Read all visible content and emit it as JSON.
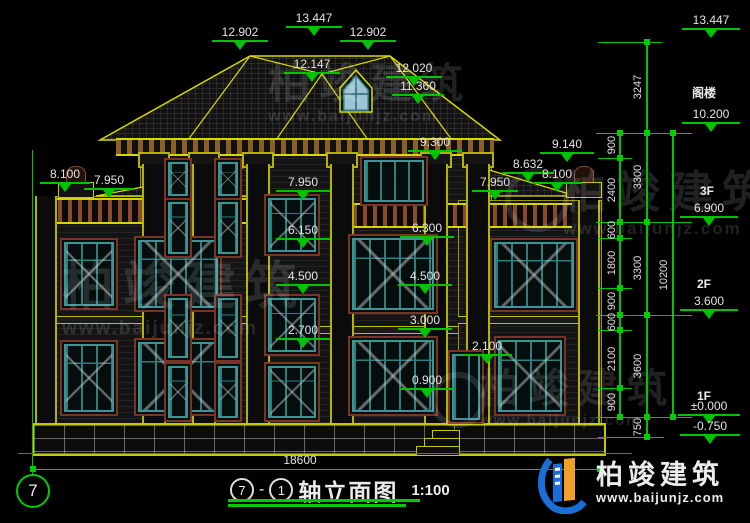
{
  "palette": {
    "green": "#00cc00",
    "yellow": "#d8d800",
    "teal": "#3d9494",
    "trim_brown": "#7a3424",
    "logo_blue": "#1a6ed8",
    "logo_orange": "#f0a028",
    "background": "#000000"
  },
  "axis": {
    "label": "7"
  },
  "title": {
    "axis_a": "7",
    "dash": "-",
    "axis_b": "1",
    "name": "轴立面图",
    "scale": "1:100"
  },
  "bottom": {
    "width_dim": "18600"
  },
  "levels": {
    "attic": "阁楼",
    "f3": "3F",
    "f2": "2F",
    "f1": "1F"
  },
  "marks": [
    {
      "value": "13.447"
    },
    {
      "value": "12.902"
    },
    {
      "value": "12.902"
    },
    {
      "value": "12.147"
    },
    {
      "value": "12.020"
    },
    {
      "value": "11.360"
    },
    {
      "value": "8.100"
    },
    {
      "value": "7.950"
    },
    {
      "value": "7.950"
    },
    {
      "value": "6.150"
    },
    {
      "value": "4.500"
    },
    {
      "value": "2.700"
    },
    {
      "value": "9.300"
    },
    {
      "value": "6.300"
    },
    {
      "value": "4.500"
    },
    {
      "value": "3.000"
    },
    {
      "value": "0.900"
    },
    {
      "value": "2.100"
    },
    {
      "value": "9.140"
    },
    {
      "value": "8.632"
    },
    {
      "value": "8.100"
    },
    {
      "value": "7.950"
    },
    {
      "value": "13.447"
    },
    {
      "value": "10.200"
    },
    {
      "value": "6.900"
    },
    {
      "value": "3.600"
    },
    {
      "value": "±0.000"
    },
    {
      "value": "-0.750"
    }
  ],
  "dims": {
    "inner": [
      "900",
      "2400",
      "600",
      "1800",
      "900",
      "600",
      "2100",
      "900"
    ],
    "middle": [
      "3247",
      "3300",
      "3300",
      "3600",
      "750"
    ],
    "outer": [
      "10200"
    ]
  },
  "watermark": {
    "cn": "柏竣建筑",
    "url": "www.baijunjz.com"
  },
  "logo": {
    "cn": "柏竣建筑",
    "url": "www.baijunjz.com"
  }
}
